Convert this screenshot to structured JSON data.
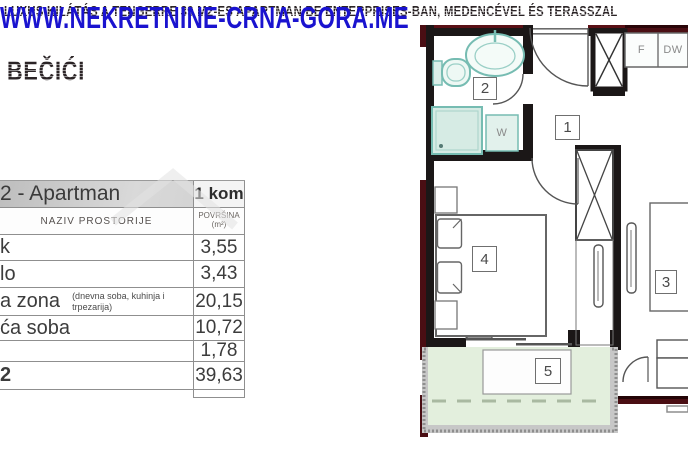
{
  "page": {
    "title": "LUXUS KILÁTÁS A TENGERRE 39 M2-ES APARTMAN BE ENTERPRISES-BAN, MEDENCÉVEL ÉS TERASSZAL",
    "location": "BEČIĆI",
    "watermark": "WWW.NEKRETNINE-CRNA-GORA.ME"
  },
  "table": {
    "title": "2 - Apartman",
    "count": "1 kom",
    "col_name": "NAZIV PROSTORIJE",
    "col_area": "POVRŠINA",
    "col_area_unit": "(m²)",
    "rows": [
      {
        "name": "k",
        "note": "",
        "value": "3,55"
      },
      {
        "name": "lo",
        "note": "",
        "value": "3,43"
      },
      {
        "name": "a zona",
        "note": "(dnevna soba, kuhinja i trpezarija)",
        "value": "20,15"
      },
      {
        "name": "ća soba",
        "note": "",
        "value": "10,72"
      },
      {
        "name": "",
        "note": "",
        "value": "1,78"
      }
    ],
    "total": {
      "name": "2",
      "value": "39,63"
    }
  },
  "floorplan": {
    "labels": {
      "hall": "1",
      "bathroom": "2",
      "room3": "3",
      "bedroom": "4",
      "terrace": "5",
      "washer": "W",
      "fridge": "F",
      "dishwasher": "DW"
    }
  },
  "colors": {
    "wall_black": "#1b1717",
    "wall_red": "#4a0e13",
    "fixture_teal": "#76bcb2",
    "terrace_green": "#e3efdd",
    "watermark_blue": "#1a13cf"
  }
}
